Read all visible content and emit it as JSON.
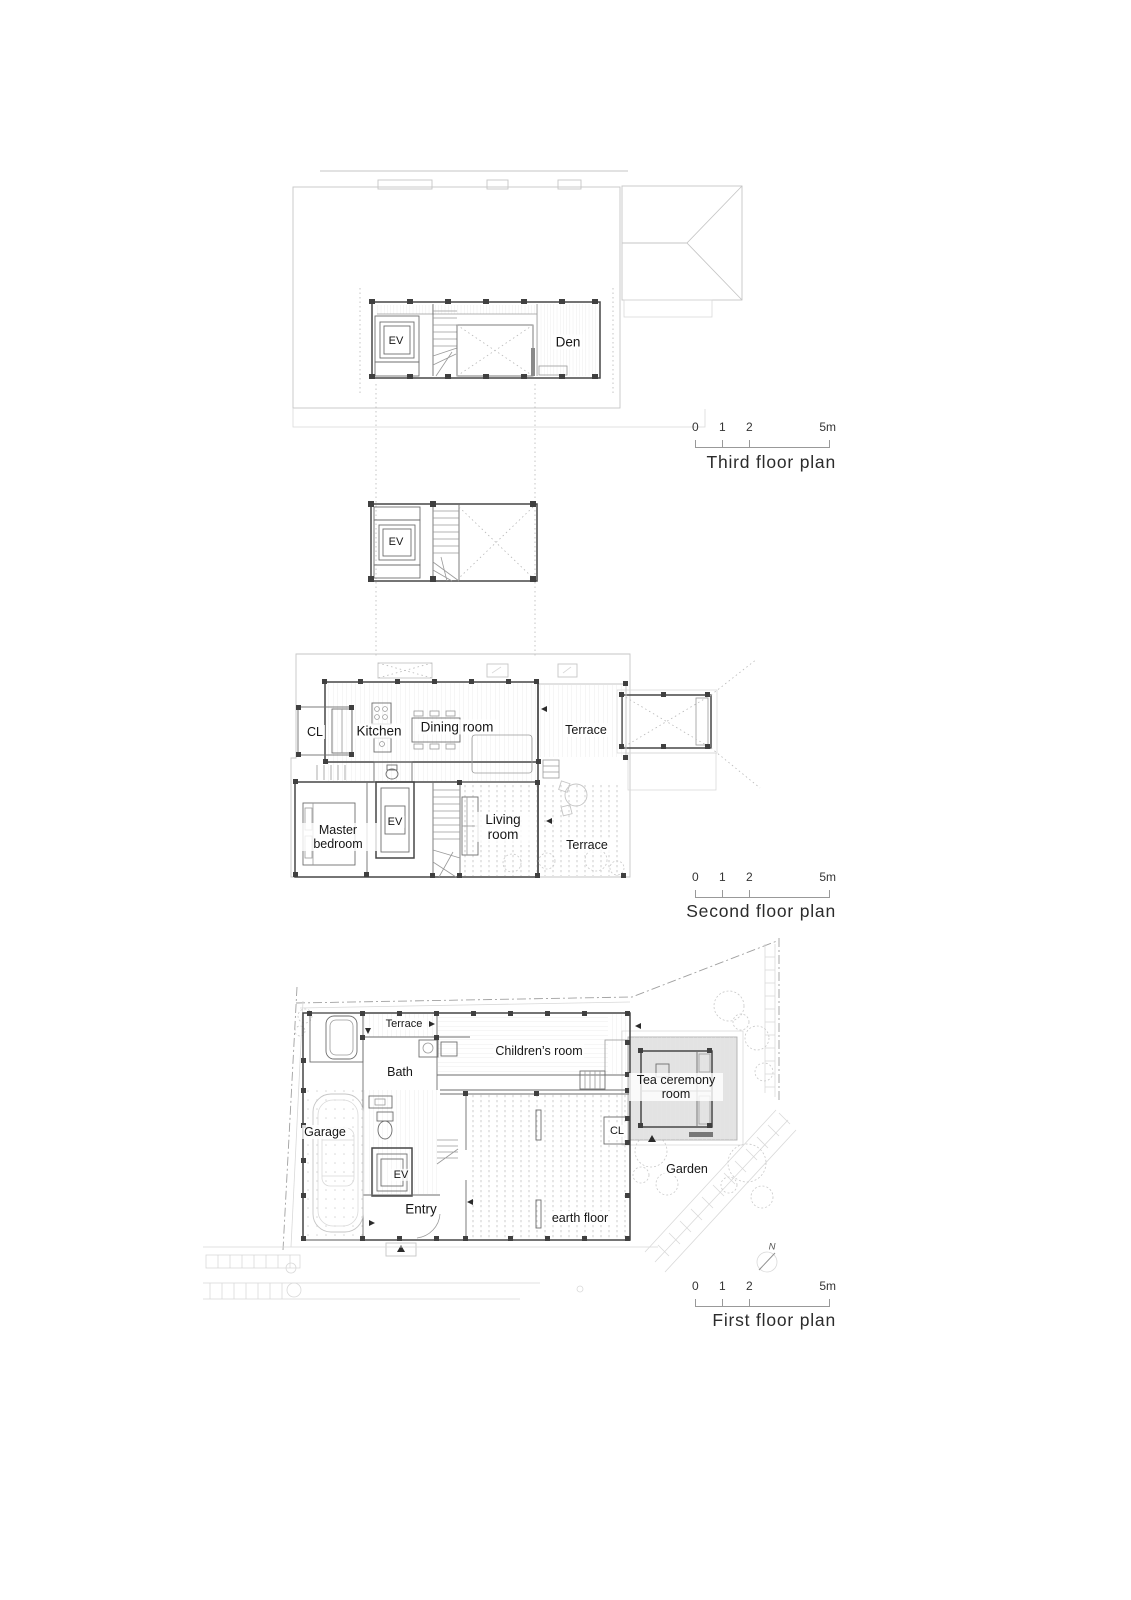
{
  "page": {
    "background": "#ffffff",
    "wall_color": "#474747",
    "eave_color": "#c6c6c6",
    "shade_color": "#e3e3e3"
  },
  "third_floor": {
    "caption": "Third floor plan",
    "rooms": {
      "ev": "EV",
      "den": "Den"
    },
    "scale_bar": {
      "t0": "0",
      "t1": "1",
      "t2": "2",
      "t3": "5m"
    }
  },
  "loft": {
    "rooms": {
      "ev": "EV"
    }
  },
  "second_floor": {
    "caption": "Second floor plan",
    "rooms": {
      "cl": "CL",
      "kitchen": "Kitchen",
      "dining": "Dining room",
      "terrace_upper": "Terrace",
      "master_bedroom": "Master bedroom",
      "ev": "EV",
      "living": "Living room",
      "terrace_lower": "Terrace"
    },
    "scale_bar": {
      "t0": "0",
      "t1": "1",
      "t2": "2",
      "t3": "5m"
    }
  },
  "first_floor": {
    "caption": "First floor plan",
    "rooms": {
      "terrace": "Terrace",
      "bath": "Bath",
      "children": "Children’s room",
      "tea_room": "Tea ceremony room",
      "garage": "Garage",
      "ev": "EV",
      "entry": "Entry",
      "cl": "CL",
      "earth_floor": "earth floor",
      "garden": "Garden"
    },
    "compass_n": "N",
    "scale_bar": {
      "t0": "0",
      "t1": "1",
      "t2": "2",
      "t3": "5m"
    }
  }
}
